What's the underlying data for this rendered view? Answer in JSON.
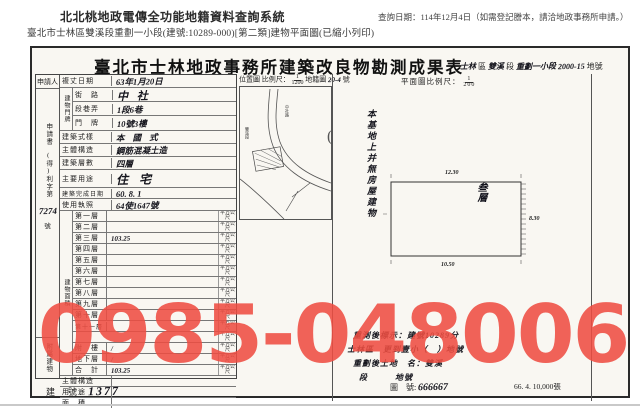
{
  "page": {
    "system_title": "北北桃地政電傳全功能地籍資料查詢系統",
    "query_date_note": "查詢日期：114年12月4日（如需登記謄本，請洽地政事務所申請。）",
    "subtitle": "臺北市士林區雙溪段重劃一小段(建號:10289-000)[第二類]建物平面圖(已縮小列印)",
    "watermark_phone": "0985-048006"
  },
  "form": {
    "title": "臺北市士林地政事務所建築改良物勘測成果表",
    "title_right": {
      "district": "士林",
      "district_suffix": "區",
      "section": "雙溪",
      "section_suffix": "段",
      "subsection": "重劃一小段",
      "parcel": "2000-15",
      "parcel_suffix": "地號"
    },
    "applicant_label": "申請人",
    "docket": {
      "top": "申請書",
      "mid": "(得)利字第",
      "no": "7274",
      "suffix": "號"
    },
    "survey_date_label": "複丈日期",
    "survey_date": "63年1月20日",
    "door_group_label": "建物門牌",
    "street_label": "街　路",
    "street": "中 社",
    "lane_label": "段巷弄",
    "lane": "1段6巷",
    "door_label": "門　牌",
    "door": "10號3樓",
    "style_label": "建築式樣",
    "style": "本 國 式",
    "structure_label": "主體構造",
    "structure": "鋼筋混凝土造",
    "storeys_label": "建築層數",
    "storeys": "四層",
    "usage_label": "主要用途",
    "usage": "住 宅",
    "completed_label": "建築完成日期",
    "completed": "60. 8. 1",
    "license_label": "使用執照",
    "license": "64使1647號",
    "area_group_label": "建物面積",
    "unit": "平方公尺",
    "floor_rows": [
      {
        "label": "第一層",
        "value": ""
      },
      {
        "label": "第二層",
        "value": ""
      },
      {
        "label": "第三層",
        "value": "103.25"
      },
      {
        "label": "第四層",
        "value": ""
      },
      {
        "label": "第五層",
        "value": ""
      },
      {
        "label": "第六層",
        "value": ""
      },
      {
        "label": "第七層",
        "value": ""
      },
      {
        "label": "第八層",
        "value": ""
      },
      {
        "label": "第九層",
        "value": ""
      },
      {
        "label": "第十層",
        "value": ""
      },
      {
        "label": "第十一層",
        "value": ""
      },
      {
        "label": "",
        "value": ""
      },
      {
        "label": "附　樓",
        "value": "/"
      },
      {
        "label": "地下層",
        "value": "/"
      },
      {
        "label": "合　計",
        "value": "103.25"
      }
    ],
    "annex_group_label": "附屬建物",
    "annex_rows": [
      {
        "label": "主體構造",
        "value": ""
      },
      {
        "label": "用　途",
        "value": ""
      },
      {
        "label": "面　積",
        "value": ""
      }
    ],
    "building_no_label": "建　號:",
    "building_no": "1377"
  },
  "map": {
    "loc_label": "位置圖",
    "scale_label": "比例尺：",
    "scale_num": "1",
    "scale_den": "1200",
    "cad_label": "地籍圖",
    "cad_no": "20-4",
    "cad_suffix": "號",
    "road_label": "中社路",
    "area_label": "雙溪段"
  },
  "plan": {
    "header": "平面圖比例尺：",
    "scale_num": "1",
    "scale_den": "200",
    "side_note": "本基地上并無房屋建物",
    "room_label": "叁層",
    "dim_top": "12.30",
    "dim_right": "8.30",
    "dim_bottom": "10.50",
    "paren": "(",
    "notes": [
      "重測後標示：建號10289分",
      "士林區　更到壹小（　）地號",
      "重劃後土地　名：雙溪",
      "段　　　地號"
    ],
    "sheet_label": "圖　號:",
    "sheet_no": "666667",
    "print_info": "66. 4. 10,000張"
  }
}
